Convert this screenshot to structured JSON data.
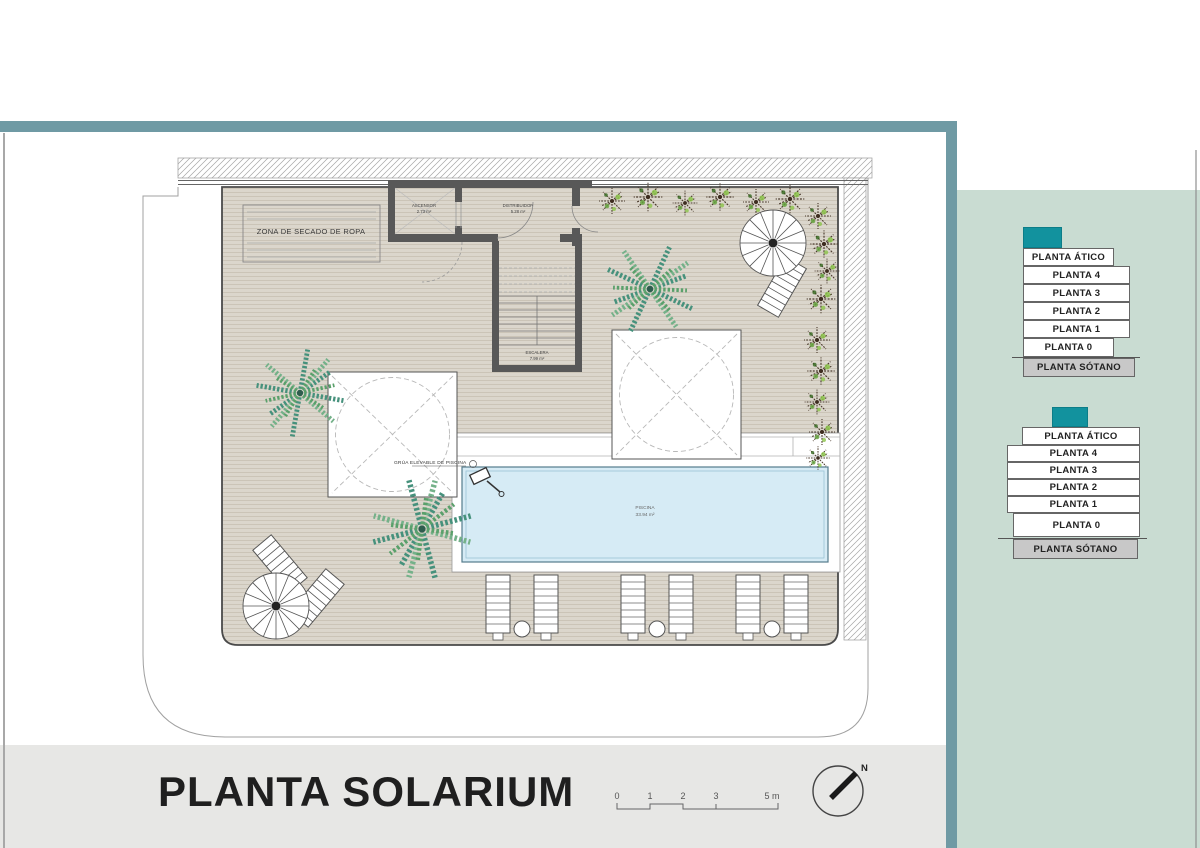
{
  "plan": {
    "zona": "ZONA DE SECADO DE ROPA",
    "ascensor_name": "ASCENSOR",
    "ascensor_area": "2.73 m²",
    "distribuidor_name": "DISTRIBUIDOR",
    "distribuidor_area": "5.28 m²",
    "escalera_name": "ESCALERA",
    "escalera_area": "7.99 m²",
    "piscina_name": "PISCINA",
    "piscina_area": "33.94 m²",
    "grua": "GRÚA ELEVABLE DE PISCINA"
  },
  "footer": {
    "title": "PLANTA SOLARIUM",
    "scale": [
      "0",
      "1",
      "2",
      "3",
      "5 m"
    ],
    "north": "N"
  },
  "panel": {
    "stacks": [
      {
        "levels": [
          "PLANTA ÁTICO",
          "PLANTA 4",
          "PLANTA 3",
          "PLANTA 2",
          "PLANTA 1",
          "PLANTA 0",
          "PLANTA SÓTANO"
        ]
      },
      {
        "levels": [
          "PLANTA ÁTICO",
          "PLANTA 4",
          "PLANTA 3",
          "PLANTA 2",
          "PLANTA 1",
          "PLANTA 0",
          "PLANTA SÓTANO"
        ]
      }
    ]
  },
  "colors": {
    "teal_bar": "#6f9aa4",
    "accent_teal": "#12929e",
    "panel_green": "#c9dcd2",
    "pool_blue": "#d6ebf5",
    "deck_beige": "#dbd6cc",
    "sotano_gray": "#c8c8c8",
    "footer_gray": "#e7e7e5"
  }
}
